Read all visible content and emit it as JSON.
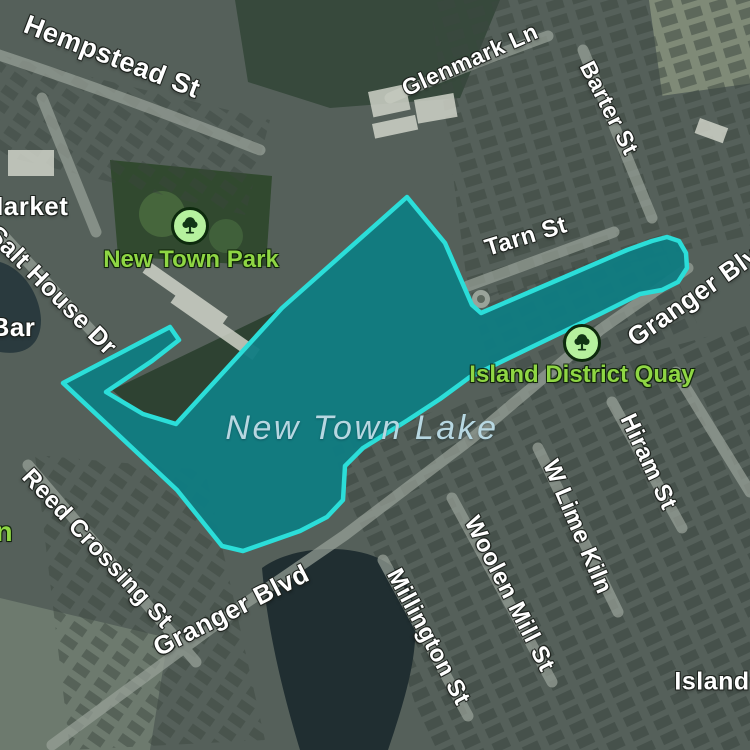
{
  "map": {
    "title": "New Town Lake area satellite map",
    "overlay": {
      "label": "New Town Lake highlighted region",
      "fill": "#0F7C82",
      "fill_opacity": "0.95",
      "stroke": "#2BDED9",
      "stroke_width": "4.5",
      "points": "63,383 170,327 179,340 152,361 106,392 143,414 176,424 282,308 407,197 445,243 472,305 481,313 560,279 627,250 652,241 667,237 679,241 686,253 687,268 678,282 662,290 640,294 600,314 540,343 470,377 440,399 408,420 363,448 345,466 343,500 327,517 300,531 243,551 222,546 177,490"
    },
    "labels": [
      {
        "text": "Hempstead St",
        "kind": "street"
      },
      {
        "text": "Glenmark Ln",
        "kind": "street"
      },
      {
        "text": "Barter St",
        "kind": "street"
      },
      {
        "text": "Tarn St",
        "kind": "street"
      },
      {
        "text": "Salt House Dr",
        "kind": "street"
      },
      {
        "text": "Granger Blvd",
        "kind": "street"
      },
      {
        "text": "Granger Blvd",
        "kind": "street"
      },
      {
        "text": "Reed Crossing St",
        "kind": "street"
      },
      {
        "text": "Millington St",
        "kind": "street"
      },
      {
        "text": "Woolen Mill St",
        "kind": "street"
      },
      {
        "text": "W Lime Kiln",
        "kind": "street"
      },
      {
        "text": "Hiram St",
        "kind": "street"
      },
      {
        "text": "Island",
        "kind": "locality"
      },
      {
        "text": "Market",
        "kind": "locality"
      },
      {
        "text": "Bar",
        "kind": "locality"
      },
      {
        "text": "n",
        "kind": "poi"
      },
      {
        "text": "New Town Park",
        "kind": "poi"
      },
      {
        "text": "Island District Quay",
        "kind": "poi"
      },
      {
        "text": "New Town Lake",
        "kind": "water"
      }
    ],
    "poi_icons": [
      {
        "icon": "tree-icon",
        "poi": "New Town Park"
      },
      {
        "icon": "tree-icon",
        "poi": "Island District Quay"
      }
    ],
    "colors": {
      "street_text": "#FFFFFF",
      "poi_text": "#8FD644",
      "water_text": "#B7D7E1",
      "icon_bg": "#B6F19E",
      "icon_ring": "#0D2A0D",
      "icon_glyph": "#123615",
      "overlay_fill": "#0F7C82",
      "overlay_stroke": "#2BDED9"
    }
  }
}
